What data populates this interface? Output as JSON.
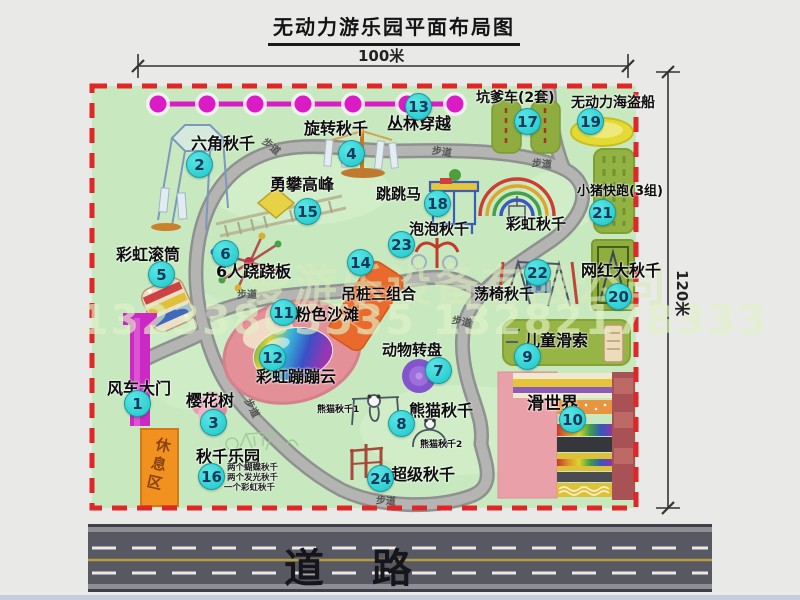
{
  "title": "无动力游乐园平面布局图",
  "dims": {
    "top": "100米",
    "right": "120米"
  },
  "watermark": {
    "company": "爱游乐设备有限公司",
    "phones": "13233805535 13282178333"
  },
  "road": {
    "label": "道 路"
  },
  "park": {
    "path_label": "步道",
    "rest_area": "休息区",
    "rainbow_swing": "彩虹秋千",
    "panda_sub1": "熊猫秋千1",
    "panda_sub2": "熊猫秋千2",
    "swing_notes": [
      "两个蝴蝶秋千",
      "两个发光秋千",
      "一个彩虹秋千"
    ],
    "accent_colors": {
      "border": "#e02626",
      "marker": "#1fc6c9",
      "gate": "#cb28c4",
      "bead_line": "#db1cc6"
    },
    "items": [
      {
        "num": "1",
        "label": "风车大门"
      },
      {
        "num": "2",
        "label": "六角秋千"
      },
      {
        "num": "3",
        "label": "樱花树"
      },
      {
        "num": "4",
        "label": "旋转秋千"
      },
      {
        "num": "5",
        "label": "彩虹滚筒"
      },
      {
        "num": "6",
        "label": "6人跷跷板"
      },
      {
        "num": "7",
        "label": "动物转盘"
      },
      {
        "num": "8",
        "label": "熊猫秋千"
      },
      {
        "num": "9",
        "label": "儿童滑索"
      },
      {
        "num": "10",
        "label": "滑世界"
      },
      {
        "num": "11",
        "label": "粉色沙滩"
      },
      {
        "num": "12",
        "label": "彩虹蹦蹦云"
      },
      {
        "num": "13",
        "label": "丛林穿越"
      },
      {
        "num": "14",
        "label": "吊桩三组合"
      },
      {
        "num": "15",
        "label": "勇攀高峰"
      },
      {
        "num": "16",
        "label": "秋千乐园"
      },
      {
        "num": "17",
        "label": "坑爹车(2套)"
      },
      {
        "num": "18",
        "label": "跳跳马"
      },
      {
        "num": "19",
        "label": "无动力海盗船"
      },
      {
        "num": "20",
        "label": "网红大秋千"
      },
      {
        "num": "21",
        "label": "小猪快跑(3组)"
      },
      {
        "num": "22",
        "label": "荡椅秋千"
      },
      {
        "num": "23",
        "label": "泡泡秋千"
      },
      {
        "num": "24",
        "label": "超级秋千"
      }
    ]
  }
}
